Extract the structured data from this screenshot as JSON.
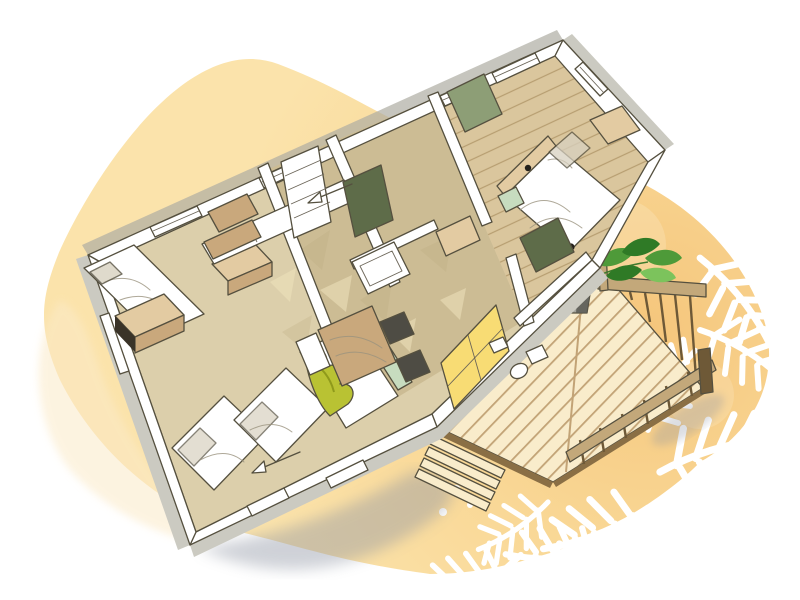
{
  "scene": {
    "type": "isometric-floorplan-illustration",
    "subject": "mobile-home-floor-plan-with-wood-deck",
    "elements": [
      "watercolor-blob-background",
      "floor-plan",
      "wood-deck",
      "deck-railing",
      "deck-steps",
      "potted-plant",
      "palm-leaf-silhouettes",
      "building-shadow"
    ]
  },
  "colors": {
    "page_bg": "#ffffff",
    "blob_deep": "#f5c67c",
    "blob_mid": "#f9d795",
    "blob_main": "#fbe3ab",
    "blob_wash": "#fbeac8",
    "blotch_light": "#fdeccb",
    "shadow": "#8e94a3",
    "outline": "#55503f",
    "wall_white": "#ffffff",
    "wall_gray": "#cbcac1",
    "wall_gray_dark": "#aeada2",
    "floor_light": "#dccfab",
    "floor_main": "#ccbc94",
    "floor_shade": "#b9a87f",
    "floor_crease": "#efe3bd",
    "floor_wood": "#dac69d",
    "floor_wood_line": "#b79e71",
    "bed_white": "#ffffff",
    "linen_shade": "#d8d1c0",
    "olive": "#b9c233",
    "olive_dark": "#8f9a1b",
    "headboard_green": "#c7dcbf",
    "sage": "#8d9e76",
    "sage_dark": "#5e6c49",
    "wood_light": "#e3cba2",
    "wood_mid": "#c9a87c",
    "wood_dark": "#8f7347",
    "wood_opening": "#3a3328",
    "chair_dark": "#4e4c44",
    "window_yellow": "#f8dc74",
    "deck_base": "#f9eccb",
    "deck_gap": "#c2a376",
    "deck_edge": "#8a6f45",
    "rail_wood": "#c3a87a",
    "rail_dark": "#6e5937",
    "plant_green": "#4e9a39",
    "plant_dark": "#2f7a26",
    "plant_light": "#7cc35c",
    "plant_stem": "#3f7a2e",
    "pot_light": "#a3a39b",
    "pot_dark": "#5c5c55",
    "palm_white": "#ffffff",
    "mark_dark": "#23201b"
  }
}
